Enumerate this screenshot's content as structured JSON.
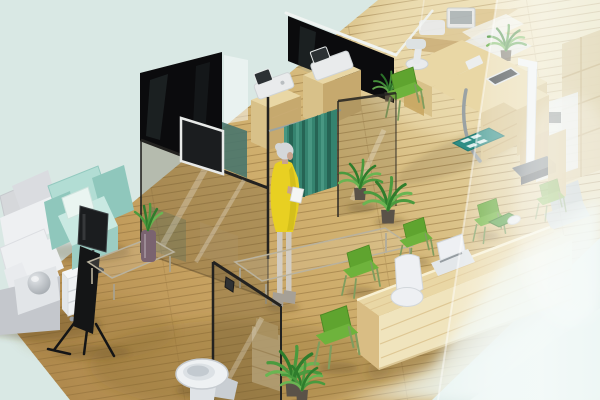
{
  "meta": {
    "type": "3d-isometric-interior-render",
    "subject": "Isometric cutaway render of a clinic interior with waiting lounge, examination cubicles, exam room, reception counter and restroom",
    "visible_text": "none"
  },
  "scene": {
    "areas": [
      {
        "id": "waiting-lounge",
        "label": "Waiting lounge with sofa, armchair, easel display and glass tables"
      },
      {
        "id": "exam-cubicles",
        "label": "Examination cubicles behind black glass panels with privacy curtain"
      },
      {
        "id": "exam-room",
        "label": "Examination room with instrument desk, stadiometer scale and teal floor mat"
      },
      {
        "id": "reception",
        "label": "Reception area with long pine counter, staff chairs and green visitor chairs"
      },
      {
        "id": "restroom",
        "label": "Restroom corner with toilet behind a framed glass door"
      },
      {
        "id": "back-office",
        "label": "Back office equipment seen hazily through frosted glass wall"
      }
    ],
    "person": {
      "id": "woman-yellow-dress",
      "label": "Gray-haired woman in a yellow dress holding white papers beside the privacy curtain"
    },
    "objects": [
      {
        "id": "sectional-sofa",
        "label": "White sectional sofa with gray back cushions",
        "area": "waiting-lounge"
      },
      {
        "id": "sphere-ornament",
        "label": "Gray sphere ornament on sofa arm",
        "area": "waiting-lounge"
      },
      {
        "id": "mint-armchair",
        "label": "Mint green cube armchair with white pillow",
        "area": "waiting-lounge"
      },
      {
        "id": "monitor-stand",
        "label": "Dark monitor on a floor stand in front of the armchair",
        "area": "waiting-lounge"
      },
      {
        "id": "display-easel",
        "label": "Black easel stand with flat panel",
        "area": "waiting-lounge"
      },
      {
        "id": "drawer-cart",
        "label": "White drawer cart on casters",
        "area": "waiting-lounge"
      },
      {
        "id": "glass-table-small",
        "label": "Small glass coffee table",
        "area": "waiting-lounge"
      },
      {
        "id": "glass-table-large",
        "label": "Long low glass table",
        "area": "waiting-lounge"
      },
      {
        "id": "aloe-vase",
        "label": "Tall mauve vase with aloe plant on the small glass table",
        "area": "waiting-lounge"
      },
      {
        "id": "black-panel-left",
        "label": "Black glass partition panel with wall TV",
        "area": "exam-cubicles"
      },
      {
        "id": "black-panel-right",
        "label": "Black glass partition panel with white top trim",
        "area": "exam-cubicles"
      },
      {
        "id": "wall-tv",
        "label": "Wall mounted TV with white bezel",
        "area": "exam-cubicles"
      },
      {
        "id": "teal-cabinet",
        "label": "Teal cabinet seen behind glass",
        "area": "exam-cubicles"
      },
      {
        "id": "equipment-pedestal-1",
        "label": "Pine pedestal with white diagnostic device",
        "area": "exam-cubicles"
      },
      {
        "id": "equipment-pedestal-2",
        "label": "Pine pedestal with white diagnostic device",
        "area": "exam-cubicles"
      },
      {
        "id": "privacy-curtain",
        "label": "Teal privacy curtain hanging from a rail",
        "area": "exam-cubicles"
      },
      {
        "id": "glass-partition-center",
        "label": "Central glass partition wall with dark edges",
        "area": "exam-cubicles"
      },
      {
        "id": "glass-panel-right",
        "label": "Free-standing glass panel right of the curtain",
        "area": "exam-room"
      },
      {
        "id": "instrument-desk",
        "label": "Light pine instrument desk with microscope device and embedded tablet",
        "area": "exam-room"
      },
      {
        "id": "chrome-tube",
        "label": "Curved chrome tube from desk to floor",
        "area": "exam-room"
      },
      {
        "id": "step-shelves",
        "label": "Stepped pine shelf blocks",
        "area": "exam-room"
      },
      {
        "id": "teal-floor-mat",
        "label": "Teal mat with four white pads",
        "area": "exam-room"
      },
      {
        "id": "stadiometer",
        "label": "White height scale with dark weighing base",
        "area": "exam-room"
      },
      {
        "id": "exam-green-chair",
        "label": "Green side chair in exam room",
        "area": "exam-room"
      },
      {
        "id": "back-counter",
        "label": "Wooden counter with monitor and printer at top edge",
        "area": "back-office"
      },
      {
        "id": "treatment-chair",
        "label": "White treatment chair behind frosted glass",
        "area": "back-office"
      },
      {
        "id": "storage-shelving",
        "label": "Tall pine storage shelving",
        "area": "back-office"
      },
      {
        "id": "medical-machine",
        "label": "White medical machine",
        "area": "back-office"
      },
      {
        "id": "blue-side-chair",
        "label": "Blue-gray side chair",
        "area": "back-office"
      },
      {
        "id": "corner-plant",
        "label": "Potted plant in back corner",
        "area": "back-office"
      },
      {
        "id": "floor-plant-1",
        "label": "Leafy floor plant",
        "area": "exam-room"
      },
      {
        "id": "floor-plant-2",
        "label": "Leafy floor plant",
        "area": "exam-room"
      },
      {
        "id": "cubicle-plant",
        "label": "Small plant behind right partition",
        "area": "exam-cubicles"
      },
      {
        "id": "reception-desk",
        "label": "Long rounded pine reception counter",
        "area": "reception"
      },
      {
        "id": "desk-tray",
        "label": "Green tray on the counter",
        "area": "reception"
      },
      {
        "id": "desk-mouse",
        "label": "White mouse beside the tray",
        "area": "reception"
      },
      {
        "id": "office-chair-white",
        "label": "White office chair behind the counter",
        "area": "reception"
      },
      {
        "id": "staff-chair-white",
        "label": "White staff chair behind the counter",
        "area": "reception"
      },
      {
        "id": "visitor-chair-1",
        "label": "Green visitor chair",
        "area": "reception"
      },
      {
        "id": "visitor-chair-2",
        "label": "Green visitor chair",
        "area": "reception"
      },
      {
        "id": "visitor-chair-3",
        "label": "Green visitor chair",
        "area": "reception"
      },
      {
        "id": "visitor-chair-4",
        "label": "Green visitor chair",
        "area": "reception"
      },
      {
        "id": "visitor-chair-5",
        "label": "Green visitor chair behind frosted glass",
        "area": "reception"
      },
      {
        "id": "entry-plant",
        "label": "Green shrub beside the glass door",
        "area": "restroom"
      },
      {
        "id": "glass-door",
        "label": "Glass door with black frame and dark handle",
        "area": "restroom"
      },
      {
        "id": "door-shelf",
        "label": "Wooden shelf boxes behind the glass door",
        "area": "restroom"
      },
      {
        "id": "toilet",
        "label": "White toilet",
        "area": "restroom"
      },
      {
        "id": "frosted-wall",
        "label": "Frosted glass wall washing out the right side",
        "area": "back-office"
      },
      {
        "id": "wood-floor",
        "label": "Light oak plank floor",
        "area": "all"
      }
    ]
  },
  "colors": {
    "background": "#d9e8e4",
    "blackPanel": "#0b0b0d",
    "panelSheen": "rgba(110,140,140,0.16)",
    "trimWhite": "#f0f4f2",
    "whitePane": "rgba(250,252,251,0.5)",
    "tealCabinet": "#49766d",
    "glassEdge": "#232220",
    "glassTint": "rgba(100,84,50,0.30)",
    "glassTintLight": "rgba(100,84,50,0.20)",
    "glassStreak": "rgba(255,255,255,0.25)",
    "railGray": "#9ca4a2",
    "curtain": "#35836f",
    "curtainShadow": "#266454",
    "curtainLight": "#4d9c87",
    "pineTop": "#e9d7a5",
    "pineFront": "#d8c189",
    "pineSide": "#c6a96e",
    "pineGrain": "#c9ab72",
    "deskFront": "#f0e4bd",
    "deskEnd": "#d9bd84",
    "deskEdgeLight": "#f8f0d2",
    "deskGrain": "#dcc28e",
    "deviceWhite": "#e9ebec",
    "deviceScreen": "#2c3134",
    "chrome": "#9aa2a4",
    "tealMat": "#2f8e85",
    "matSquare": "#e8f4f2",
    "scaleWhite": "#f0f2f3",
    "scaleBaseTop": "#6a7175",
    "scaleBase": "#454a4e",
    "chairGreen": "#5fa42f",
    "chairGreenLight": "#6eb33c",
    "chairGreenDark": "#4c8a24",
    "chairLeg": "#7f9d5e",
    "trayGreen": "#57a046",
    "whiteChair": "#eef0f3",
    "whiteChairShade": "#d2d7db",
    "chairAccent": "#959ca1",
    "sofaWhite": "#eef0f2",
    "sofaGray": "#d6d8db",
    "sofaShade": "#c4c7cc",
    "sofaSeam": "#dcdee2",
    "mint": "#b2ddd4",
    "mintDark": "#8fc7bc",
    "mintLight": "#c9e9e2",
    "mintFront": "#9ccdc3",
    "pillowWhite": "#eaf5f1",
    "screenDark": "#1b1d1f",
    "standDark": "#3a3d40",
    "easelDark": "#141516",
    "cartWhite": "#eef1f3",
    "cartShade": "#e2e6e9",
    "glassTableEdge": "#b9b29e",
    "glassTableFill": "rgba(235,230,215,0.16)",
    "glassTableLeg": "#a9a28e",
    "vase": "#7a6370",
    "leafGreen": "#4a9a3e",
    "leafDark": "#2f7d2c",
    "leafLight": "#6ab552",
    "potDark": "#5a5248",
    "hairGray": "#d4d7d9",
    "skin": "#c9a48d",
    "dressYellow": "#e8d022",
    "dressShade": "#c7b418",
    "legsTone": "#cfc9bf",
    "shoes": "#a6a096",
    "paperWhite": "#f4f5f3",
    "toiletWhite": "#eef1f3",
    "toiletShade": "#c9ced3",
    "toiletInner": "#dce1e5",
    "shadow": "rgba(88,64,30,0.28)",
    "farWood": "#e0cb9a",
    "farWoodDark": "#cdb17c",
    "farWhite": "#ebeef0",
    "farBlue": "#b7c6d2",
    "farBlueLight": "#c6d3dd",
    "shelfWood": "#dcc897",
    "shelfLine": "#c3a86f",
    "machineScreen": "#3a4246",
    "boxWood": "#d6c193",
    "boxWoodDark": "#cbb27b",
    "sphere": "#b9bec3",
    "sphereHi": "rgba(255,255,255,0.55)",
    "floorPatch": "rgba(120,88,40,0.26)",
    "floorLight": "rgba(244,233,196,0.4)",
    "plankLine": "rgba(140,108,56,0.5)",
    "frostEdge": "rgba(255,255,255,0.45)",
    "hazeCorner": "#eaf4f2"
  }
}
